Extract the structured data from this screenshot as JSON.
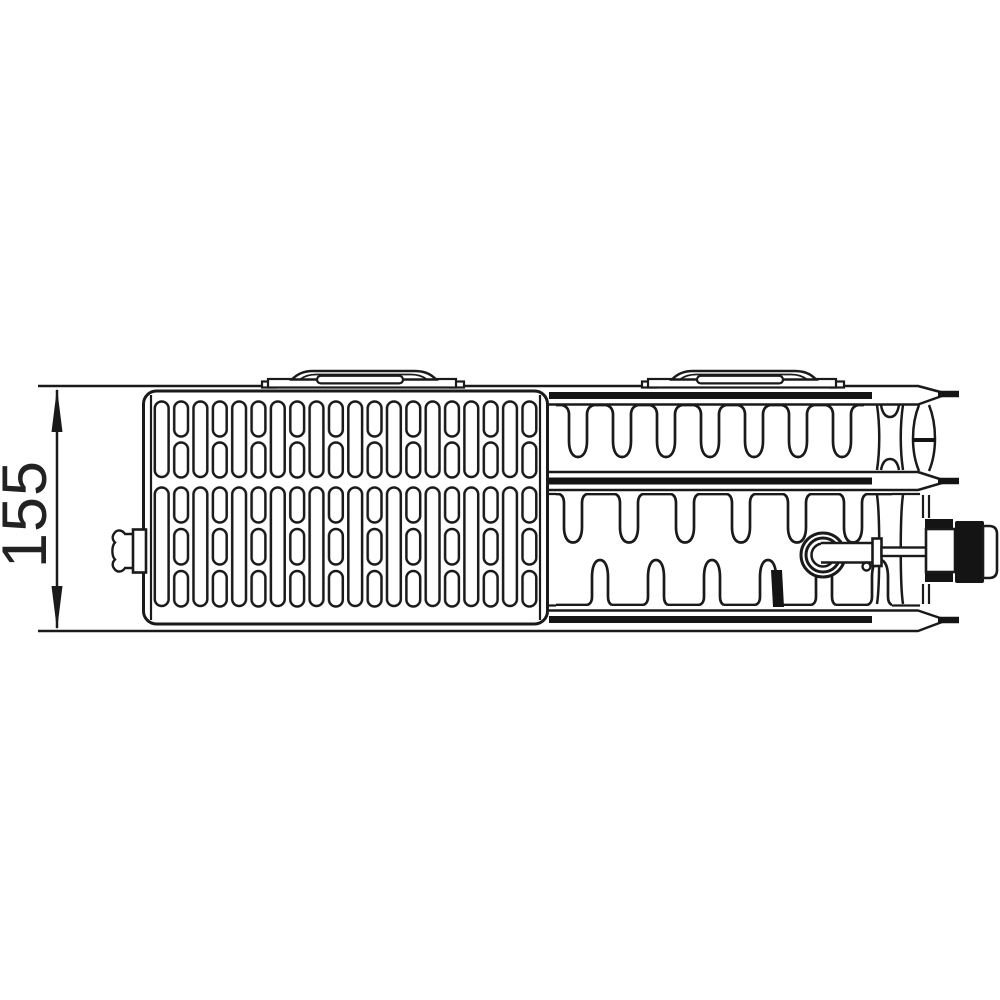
{
  "dimension": {
    "value": "155"
  },
  "colors": {
    "line": "#1a1a1a",
    "background": "#ffffff",
    "fill_dark": "#141414"
  }
}
